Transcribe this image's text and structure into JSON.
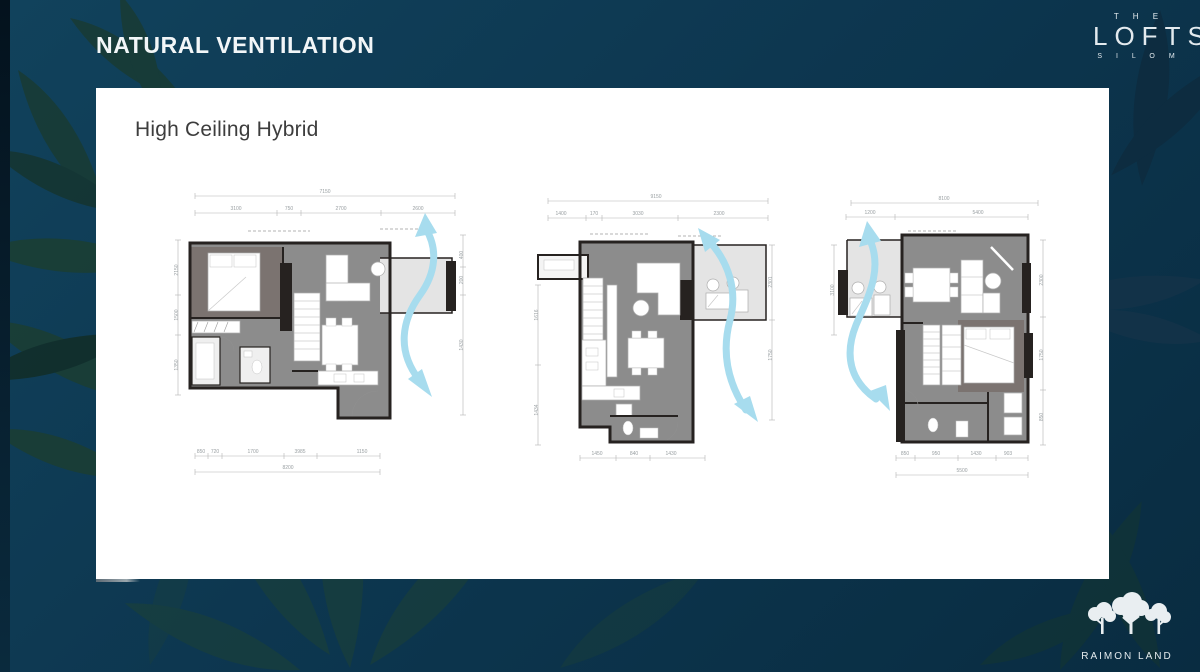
{
  "slide": {
    "title": "NATURAL VENTILATION",
    "section_heading": "High Ceiling Hybrid"
  },
  "brand": {
    "the": "T H E",
    "lofts": "LOFTS",
    "silom": "S I L O M"
  },
  "footer": {
    "logo_text": "RAIMON LAND"
  },
  "colors": {
    "background": "#0d3750",
    "panel": "#ffffff",
    "airflow_arrow": "#a7dcee",
    "wall": "#262220",
    "floor": "#8c8c8c",
    "bedroom_floor": "#7b7370",
    "balcony_floor": "#e4e4e4"
  },
  "plans": [
    {
      "dims": [
        {
          "t": "7150",
          "x": 155,
          "y": 8
        },
        {
          "t": "3100",
          "x": 66,
          "y": 25
        },
        {
          "t": "750",
          "x": 119,
          "y": 25
        },
        {
          "t": "2700",
          "x": 171,
          "y": 25
        },
        {
          "t": "2600",
          "x": 248,
          "y": 25
        },
        {
          "t": "2150",
          "x": 8,
          "y": 85,
          "r": 1
        },
        {
          "t": "1500",
          "x": 8,
          "y": 130,
          "r": 1
        },
        {
          "t": "1350",
          "x": 8,
          "y": 180,
          "r": 1
        },
        {
          "t": "400",
          "x": 293,
          "y": 70,
          "r": 1
        },
        {
          "t": "200",
          "x": 293,
          "y": 95,
          "r": 1
        },
        {
          "t": "1430",
          "x": 293,
          "y": 160,
          "r": 1
        },
        {
          "t": "850",
          "x": 31,
          "y": 268
        },
        {
          "t": "720",
          "x": 45,
          "y": 268
        },
        {
          "t": "1700",
          "x": 83,
          "y": 268
        },
        {
          "t": "3985",
          "x": 130,
          "y": 268
        },
        {
          "t": "1150",
          "x": 192,
          "y": 268
        },
        {
          "t": "8200",
          "x": 118,
          "y": 284
        }
      ]
    },
    {
      "dims": [
        {
          "t": "9150",
          "x": 128,
          "y": 8
        },
        {
          "t": "1400",
          "x": 33,
          "y": 25
        },
        {
          "t": "170",
          "x": 66,
          "y": 25
        },
        {
          "t": "3030",
          "x": 110,
          "y": 25
        },
        {
          "t": "2300",
          "x": 191,
          "y": 25
        },
        {
          "t": "1616",
          "x": 10,
          "y": 125,
          "r": 1
        },
        {
          "t": "1434",
          "x": 10,
          "y": 220,
          "r": 1
        },
        {
          "t": "2301",
          "x": 244,
          "y": 92,
          "r": 1
        },
        {
          "t": "1750",
          "x": 244,
          "y": 165,
          "r": 1
        },
        {
          "t": "1450",
          "x": 69,
          "y": 265
        },
        {
          "t": "840",
          "x": 106,
          "y": 265
        },
        {
          "t": "1430",
          "x": 143,
          "y": 265
        }
      ]
    },
    {
      "dims": [
        {
          "t": "8100",
          "x": 116,
          "y": 15
        },
        {
          "t": "1200",
          "x": 42,
          "y": 29
        },
        {
          "t": "5400",
          "x": 150,
          "y": 29
        },
        {
          "t": "3100",
          "x": 6,
          "y": 105,
          "r": 1
        },
        {
          "t": "2300",
          "x": 215,
          "y": 95,
          "r": 1
        },
        {
          "t": "1750",
          "x": 215,
          "y": 170,
          "r": 1
        },
        {
          "t": "850",
          "x": 215,
          "y": 232,
          "r": 1
        },
        {
          "t": "850",
          "x": 77,
          "y": 270
        },
        {
          "t": "950",
          "x": 108,
          "y": 270
        },
        {
          "t": "1430",
          "x": 148,
          "y": 270
        },
        {
          "t": "903",
          "x": 180,
          "y": 270
        },
        {
          "t": "5500",
          "x": 134,
          "y": 287
        }
      ]
    }
  ]
}
